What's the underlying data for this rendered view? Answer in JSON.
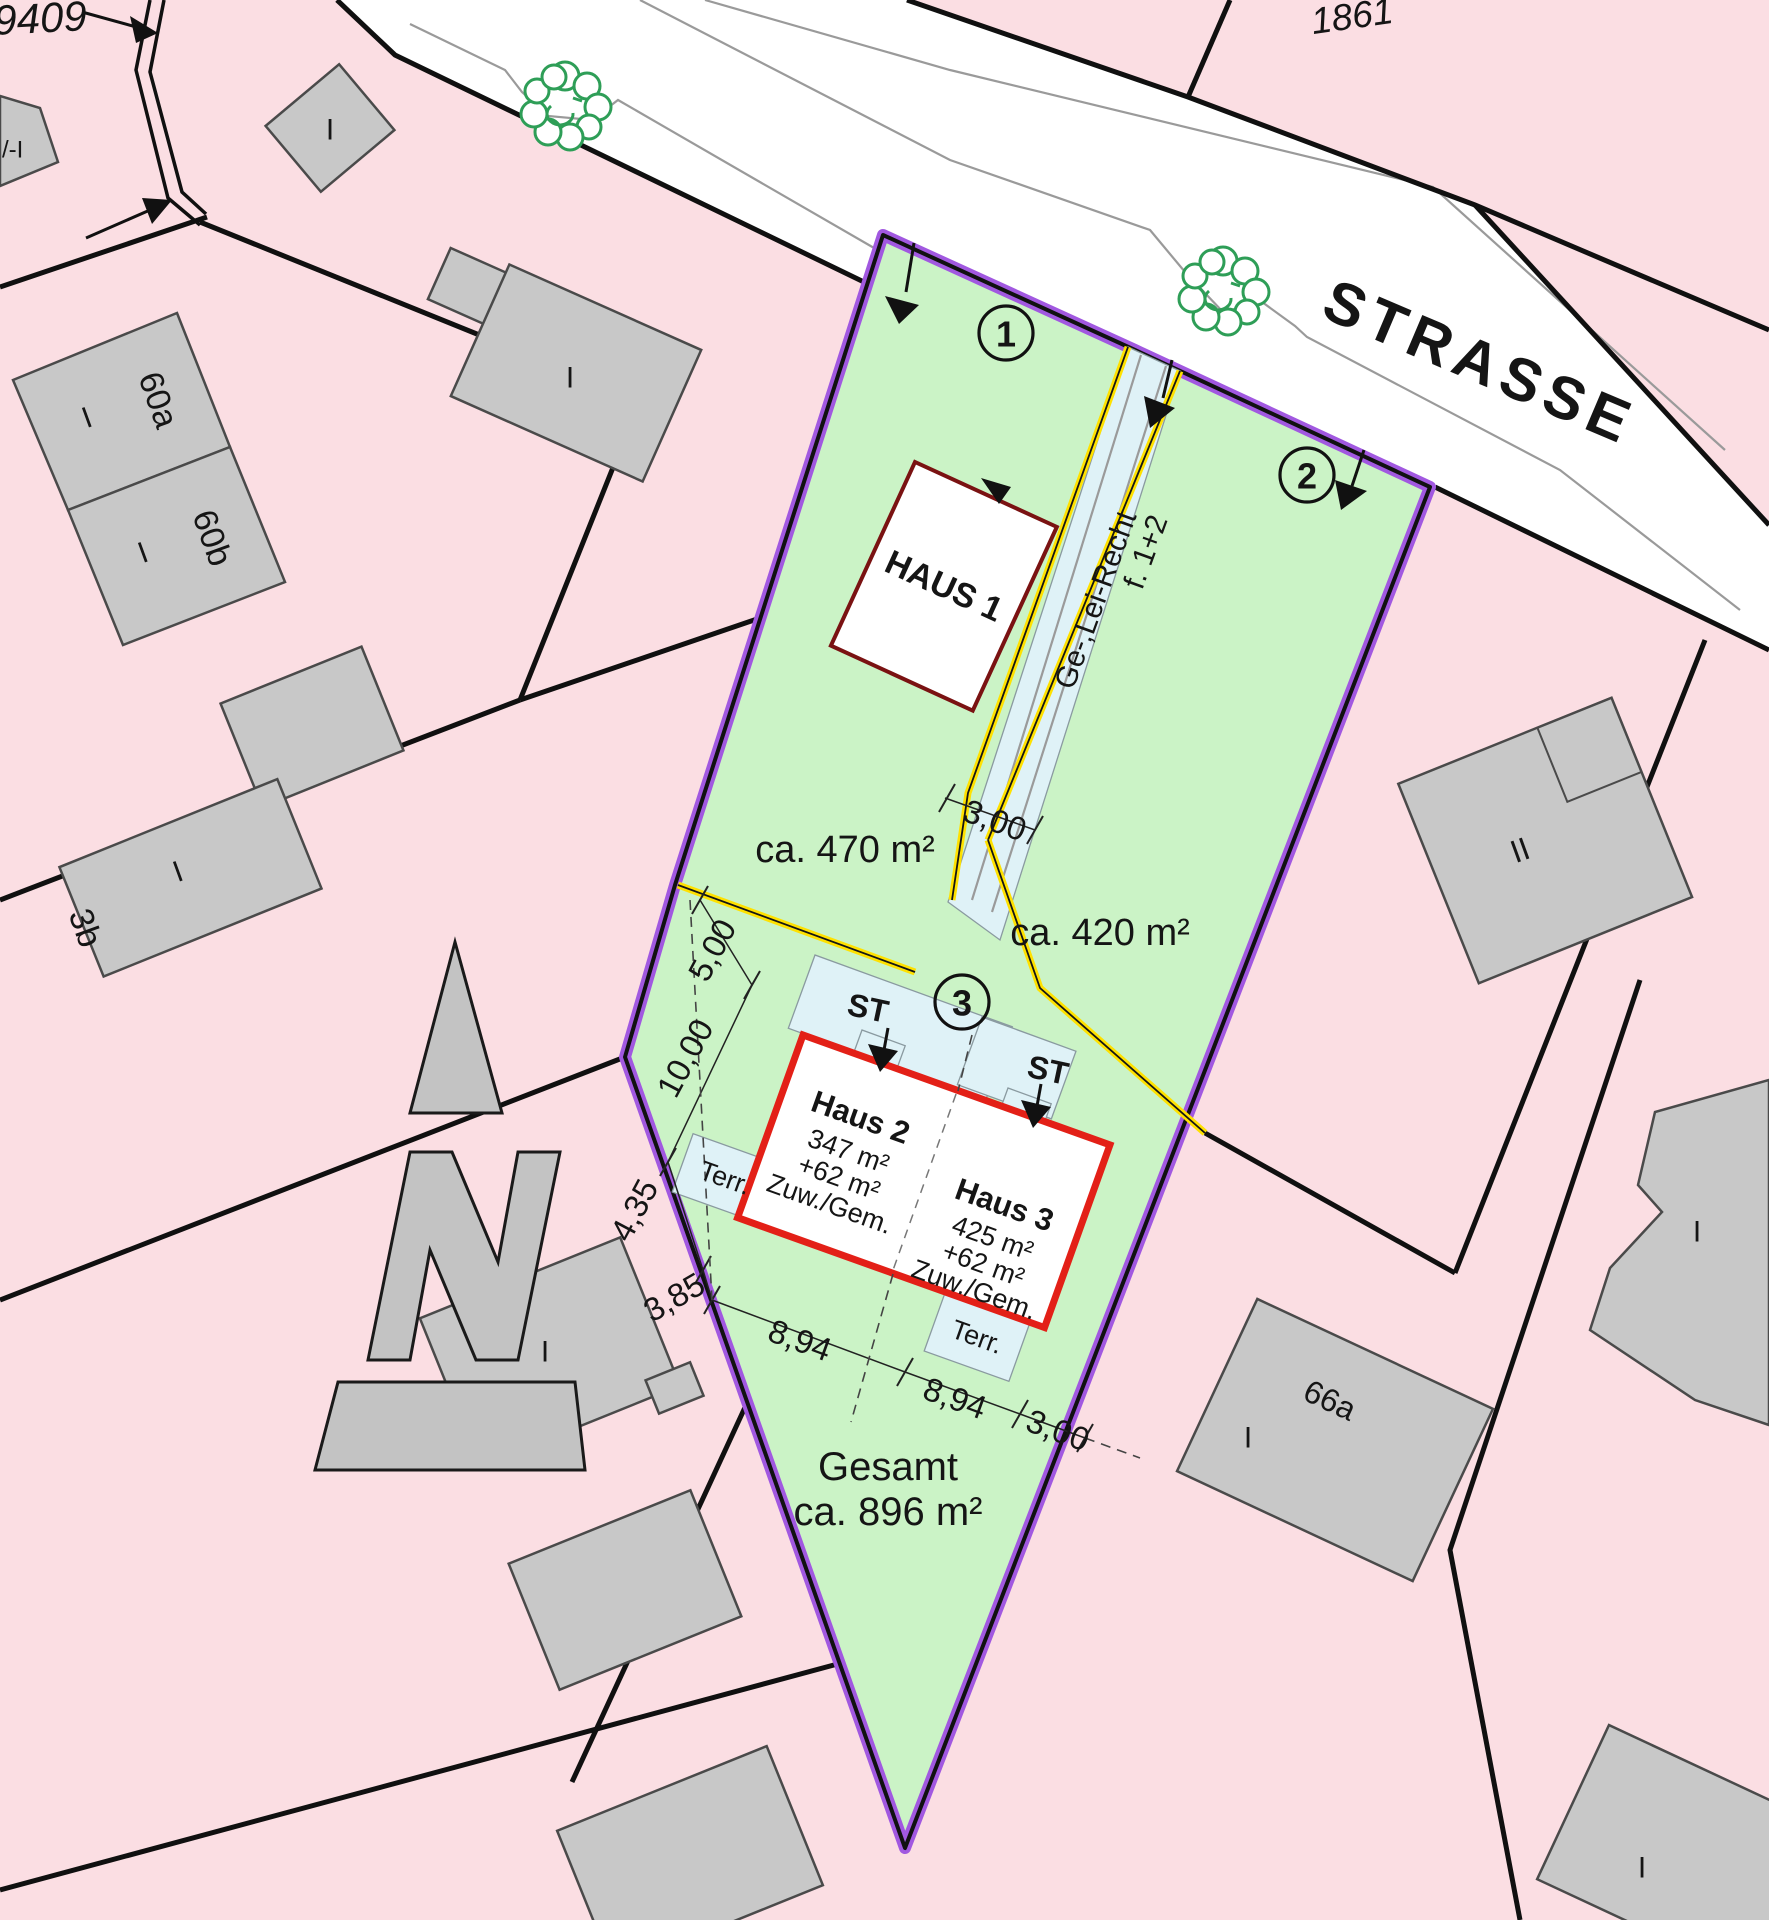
{
  "street": {
    "name": "STRASSE"
  },
  "parcels": {
    "pnum_topleft": "9409",
    "pnum_topright": "1861"
  },
  "site": {
    "total_label": "Gesamt",
    "total_area": "ca. 896 m²",
    "plot1_no": "1",
    "plot1_area": "ca. 470 m²",
    "plot2_no": "2",
    "plot2_area": "ca. 420 m²",
    "plot3_no": "3",
    "easement_line1": "Ge-,Lei-Recht",
    "easement_line2": "f. 1+2"
  },
  "houses": {
    "haus1": "HAUS 1",
    "haus2_name": "Haus 2",
    "haus2_area": "347 m²",
    "haus2_add": "+62 m²",
    "haus2_note": "Zuw./Gem.",
    "haus3_name": "Haus 3",
    "haus3_area": "425 m²",
    "haus3_add": "+62 m²",
    "haus3_note": "Zuw./Gem.",
    "parking": "ST",
    "terrace": "Terr."
  },
  "dimensions": {
    "drive_width": "3,00",
    "d5": "5,00",
    "d10": "10,00",
    "d435": "4,35",
    "d385": "3,85",
    "d894a": "8,94",
    "d894b": "8,94",
    "d3": "3,00"
  },
  "neighbors": {
    "n60a": "60a",
    "n60b": "60b",
    "n3b": "3b",
    "n66a": "66a",
    "partial_label": "/-I",
    "storey_one": "I",
    "storey_two": "II"
  },
  "colors": {
    "plot_green": "#cbf3c6",
    "boundary_purple": "#a158e0",
    "easement_yellow": "#ffe100",
    "house_red": "#e32017",
    "haus1_outline": "#7a1212",
    "paved_blue": "#dff2f7",
    "parcel_pink": "#fbdee3",
    "building_gray": "#c8c8c8"
  }
}
